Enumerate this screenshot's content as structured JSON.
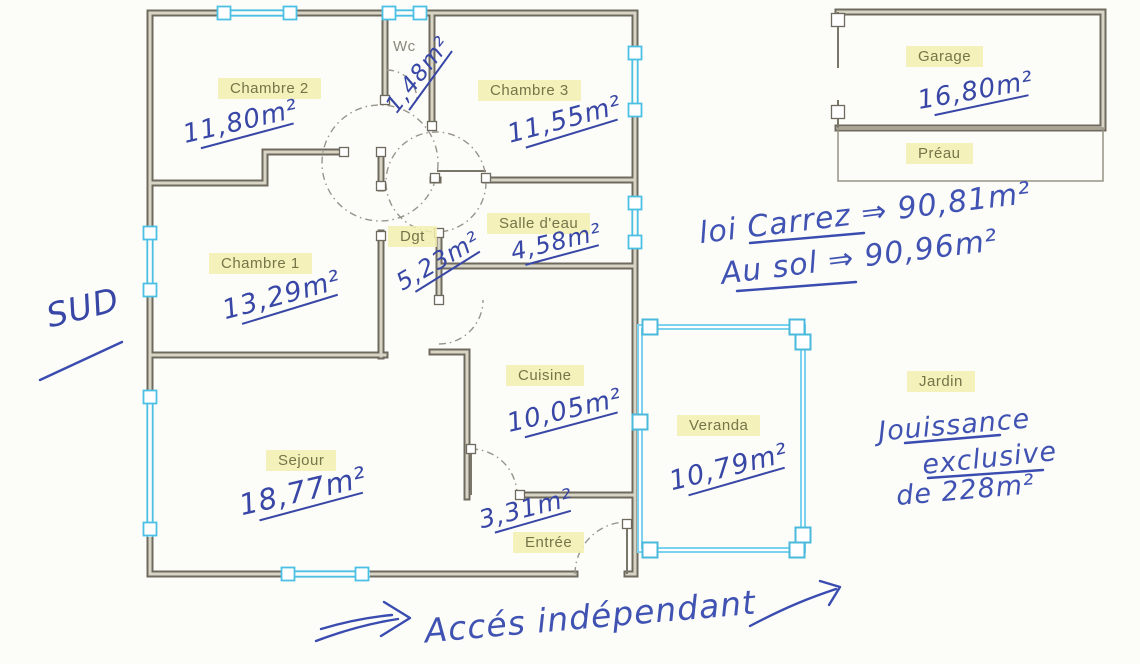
{
  "rooms": [
    {
      "id": "chambre2",
      "name": "Chambre 2",
      "area": "11,80m²"
    },
    {
      "id": "wc",
      "name": "Wc",
      "area": "1,48m²"
    },
    {
      "id": "chambre3",
      "name": "Chambre 3",
      "area": "11,55m²"
    },
    {
      "id": "salle_eau",
      "name": "Salle d'eau",
      "area": "4,58m²"
    },
    {
      "id": "dgt",
      "name": "Dgt",
      "area": "5,23m²"
    },
    {
      "id": "chambre1",
      "name": "Chambre 1",
      "area": "13,29m²"
    },
    {
      "id": "cuisine",
      "name": "Cuisine",
      "area": "10,05m²"
    },
    {
      "id": "sejour",
      "name": "Sejour",
      "area": "18,77m²"
    },
    {
      "id": "entree",
      "name": "Entrée",
      "area": "3,31m²"
    },
    {
      "id": "veranda",
      "name": "Veranda",
      "area": "10,79m²"
    },
    {
      "id": "garage",
      "name": "Garage",
      "area": "16,80m²"
    },
    {
      "id": "preau",
      "name": "Préau"
    },
    {
      "id": "jardin",
      "name": "Jardin"
    }
  ],
  "annotations": {
    "orientation": "SUD",
    "loi_carrez": "loi Carrez ⇒ 90,81m²",
    "au_sol": "Au sol ⇒ 90,96m²",
    "jouissance_1": "Jouissance",
    "jouissance_2": "exclusive",
    "jouissance_3": "de 228m²",
    "acces": "Accés indépendant"
  },
  "colors": {
    "ink_blue": "#3847a6",
    "wall": "#6e6a5e",
    "window_cyan": "#4cc0e4",
    "label_highlight": "#f3eeaf"
  }
}
